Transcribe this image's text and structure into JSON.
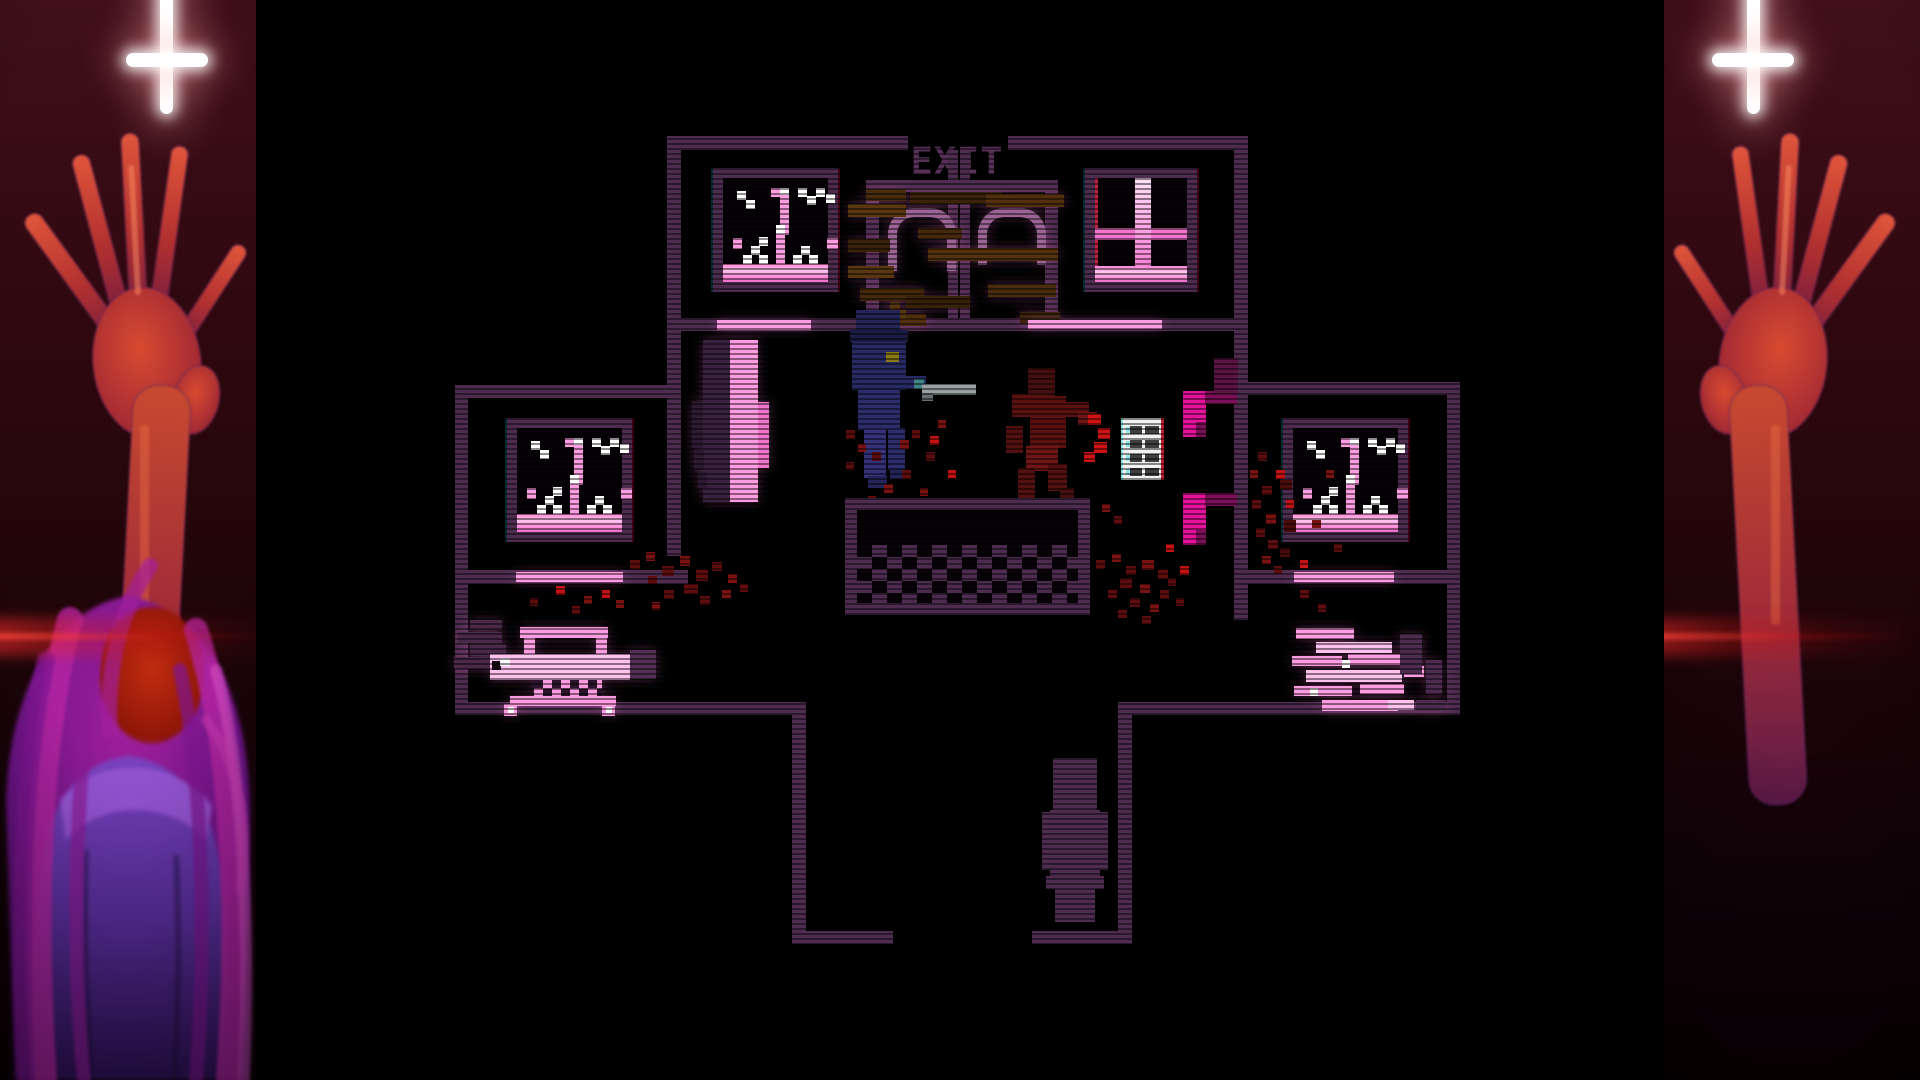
{
  "hud": {
    "exit_label": "EXIT"
  },
  "palette": {
    "wall": "#4e2c50",
    "wallDark": "#3a2040",
    "mauve": "#9c6494",
    "exit": "#583158",
    "pink": "#ff9ce2",
    "pinkLight": "#ffc2ee",
    "pinkDeep": "#f276cc",
    "magenta": "#e5129b",
    "magentaDark": "#7c0f58",
    "navy": "#272a63",
    "gunGray": "#9aa0a2",
    "bloodDark": "#5d0d0d",
    "blood": "#7a1212",
    "bloodBright": "#c41212",
    "noteWhite": "#f2f2f2",
    "noteBar": "#3f3f3f",
    "noteCyan": "#8fe8e8",
    "checkerWhite": "#ffffff",
    "plankBrown": "#52300e",
    "panelRed": "#30080f",
    "crossWhite": "#ffffff",
    "artHair": "#a21f9c",
    "artRobe": "#6a35b2",
    "artHand": "#d84a30"
  },
  "entities": [
    "exit-sign",
    "boarded-double-doors",
    "broken-window",
    "cross-window",
    "player-character",
    "corpse",
    "paper-note",
    "reception-desk",
    "swing-door",
    "corridor-door",
    "gurney",
    "wrecked-gurney",
    "blood-splatter",
    "wall-seat",
    "inverted-cross",
    "reaching-hand",
    "veiled-figure",
    "red-lens-flare"
  ]
}
